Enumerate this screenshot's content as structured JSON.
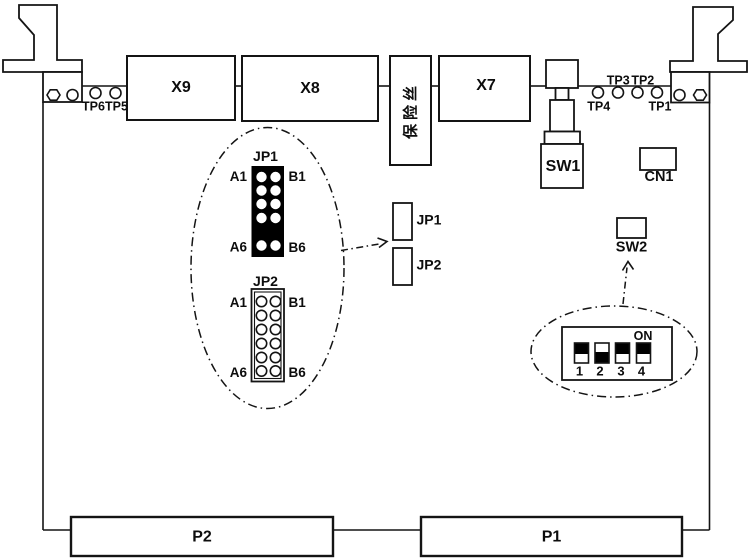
{
  "board": {
    "top_connectors": {
      "x9": "X9",
      "x8": "X8",
      "x7": "X7"
    },
    "fuse_label": "保险丝",
    "test_points": {
      "tp1": "TP1",
      "tp2": "TP2",
      "tp3": "TP3",
      "tp4": "TP4",
      "tp5": "TP5",
      "tp6": "TP6"
    },
    "switch1_label": "SW1",
    "switch2_label": "SW2",
    "cn1_label": "CN1",
    "jp1_label": "JP1",
    "jp2_label": "JP2",
    "bottom_connectors": {
      "p2": "P2",
      "p1": "P1"
    }
  },
  "jp_callout": {
    "jp1": {
      "title": "JP1",
      "a1": "A1",
      "b1": "B1",
      "a6": "A6",
      "b6": "B6"
    },
    "jp2": {
      "title": "JP2",
      "a1": "A1",
      "b1": "B1",
      "a6": "A6",
      "b6": "B6"
    }
  },
  "dip_callout": {
    "on_label": "ON",
    "positions": [
      "1",
      "2",
      "3",
      "4"
    ],
    "switch_states": [
      "up",
      "down",
      "up",
      "up"
    ]
  },
  "colors": {
    "line": "#141414",
    "text": "#0d0d0d",
    "filled_block": "#000000",
    "background": "#ffffff"
  }
}
